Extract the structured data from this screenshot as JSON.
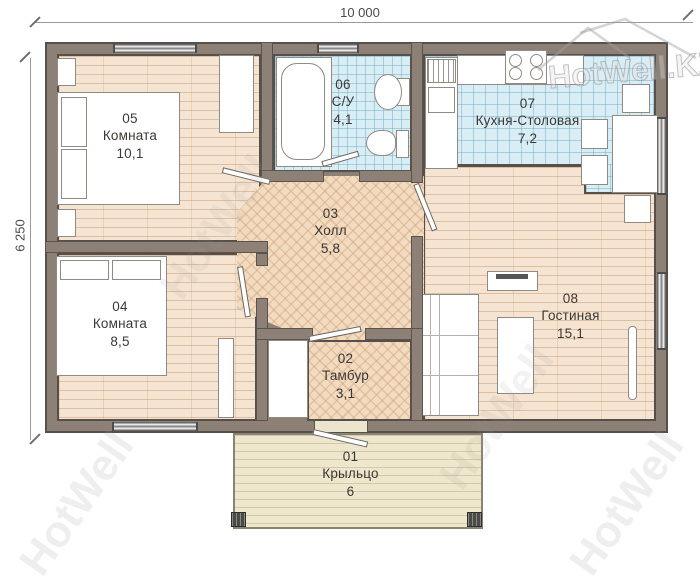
{
  "plan": {
    "dimensions": {
      "width_label": "10 000",
      "height_label": "6 250"
    },
    "rooms": [
      {
        "id": "01",
        "name": "Крыльцо",
        "area": "6"
      },
      {
        "id": "02",
        "name": "Тамбур",
        "area": "3,1"
      },
      {
        "id": "03",
        "name": "Холл",
        "area": "5,8"
      },
      {
        "id": "04",
        "name": "Комната",
        "area": "8,5"
      },
      {
        "id": "05",
        "name": "Комната",
        "area": "10,1"
      },
      {
        "id": "06",
        "name": "С/У",
        "area": "4,1"
      },
      {
        "id": "07",
        "name": "Кухня-Столовая",
        "area": "7,2"
      },
      {
        "id": "08",
        "name": "Гостиная",
        "area": "15,1"
      }
    ],
    "watermark": {
      "brand": "HotWell.KZ",
      "text": "HotWell"
    },
    "colors": {
      "wall": "#8d8076",
      "outline": "#57504a",
      "plank_floor": "#f6e4d2",
      "herringbone_floor": "#f2dbc0",
      "tile_floor": "#d9edf5",
      "porch_floor": "#eee7cd"
    }
  }
}
